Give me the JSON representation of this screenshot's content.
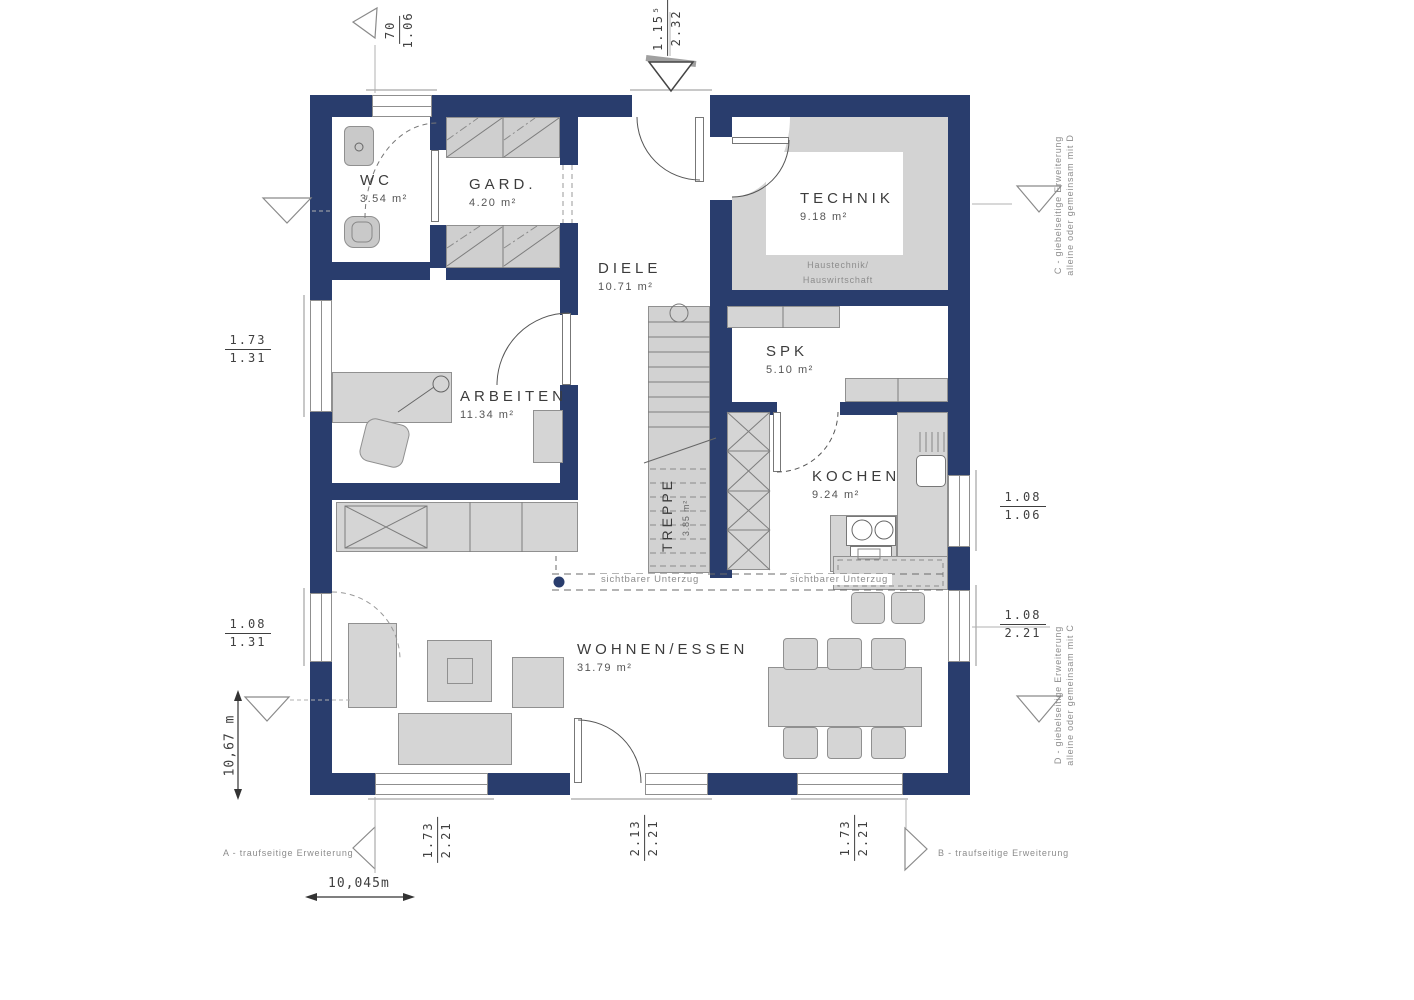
{
  "title": "Erdgeschoss Grundriss",
  "rooms": [
    {
      "name": "WC",
      "area": "3.54 m²"
    },
    {
      "name": "GARD.",
      "area": "4.20 m²"
    },
    {
      "name": "DIELE",
      "area": "10.71 m²"
    },
    {
      "name": "TECHNIK",
      "area": "9.18 m²",
      "note_line1": "Haustechnik/",
      "note_line2": "Hauswirtschaft"
    },
    {
      "name": "ARBEITEN",
      "area": "11.34 m²"
    },
    {
      "name": "SPK",
      "area": "5.10 m²"
    },
    {
      "name": "KOCHEN",
      "area": "9.24 m²"
    },
    {
      "name": "TREPPE",
      "area": "3.85 m²"
    },
    {
      "name": "WOHNEN/ESSEN",
      "area": "31.79 m²"
    }
  ],
  "beam_label": "sichtbarer Unterzug",
  "dimensions": {
    "top_left": {
      "num": "70",
      "den": "1.06"
    },
    "top_mid": {
      "num": "1.15⁵",
      "den": "2.32"
    },
    "left_upper": {
      "num": "1.73",
      "den": "1.31"
    },
    "left_lower": {
      "num": "1.08",
      "den": "1.31"
    },
    "right_upper": {
      "num": "1.08",
      "den": "1.06"
    },
    "right_lower": {
      "num": "1.08",
      "den": "2.21"
    },
    "bottom_left": {
      "num": "1.73",
      "den": "2.21"
    },
    "bottom_mid": {
      "num": "2.13",
      "den": "2.21"
    },
    "bottom_right": {
      "num": "1.73",
      "den": "2.21"
    },
    "overall_width": "10,045m",
    "overall_height": "10,67 m"
  },
  "annotations": {
    "a": "A - traufseitige Erweiterung",
    "b": "B - traufseitige Erweiterung",
    "c1": "C - giebelseitige Erweiterung",
    "c2": "alleine oder gemeinsam mit D",
    "d1": "D - giebelseitige Erweiterung",
    "d2": "alleine oder gemeinsam mit C"
  },
  "colors": {
    "wall": "#293d6d",
    "furniture": "#d5d5d5",
    "technik_floor": "#d3d3d3",
    "line": "#8f8f8f"
  }
}
